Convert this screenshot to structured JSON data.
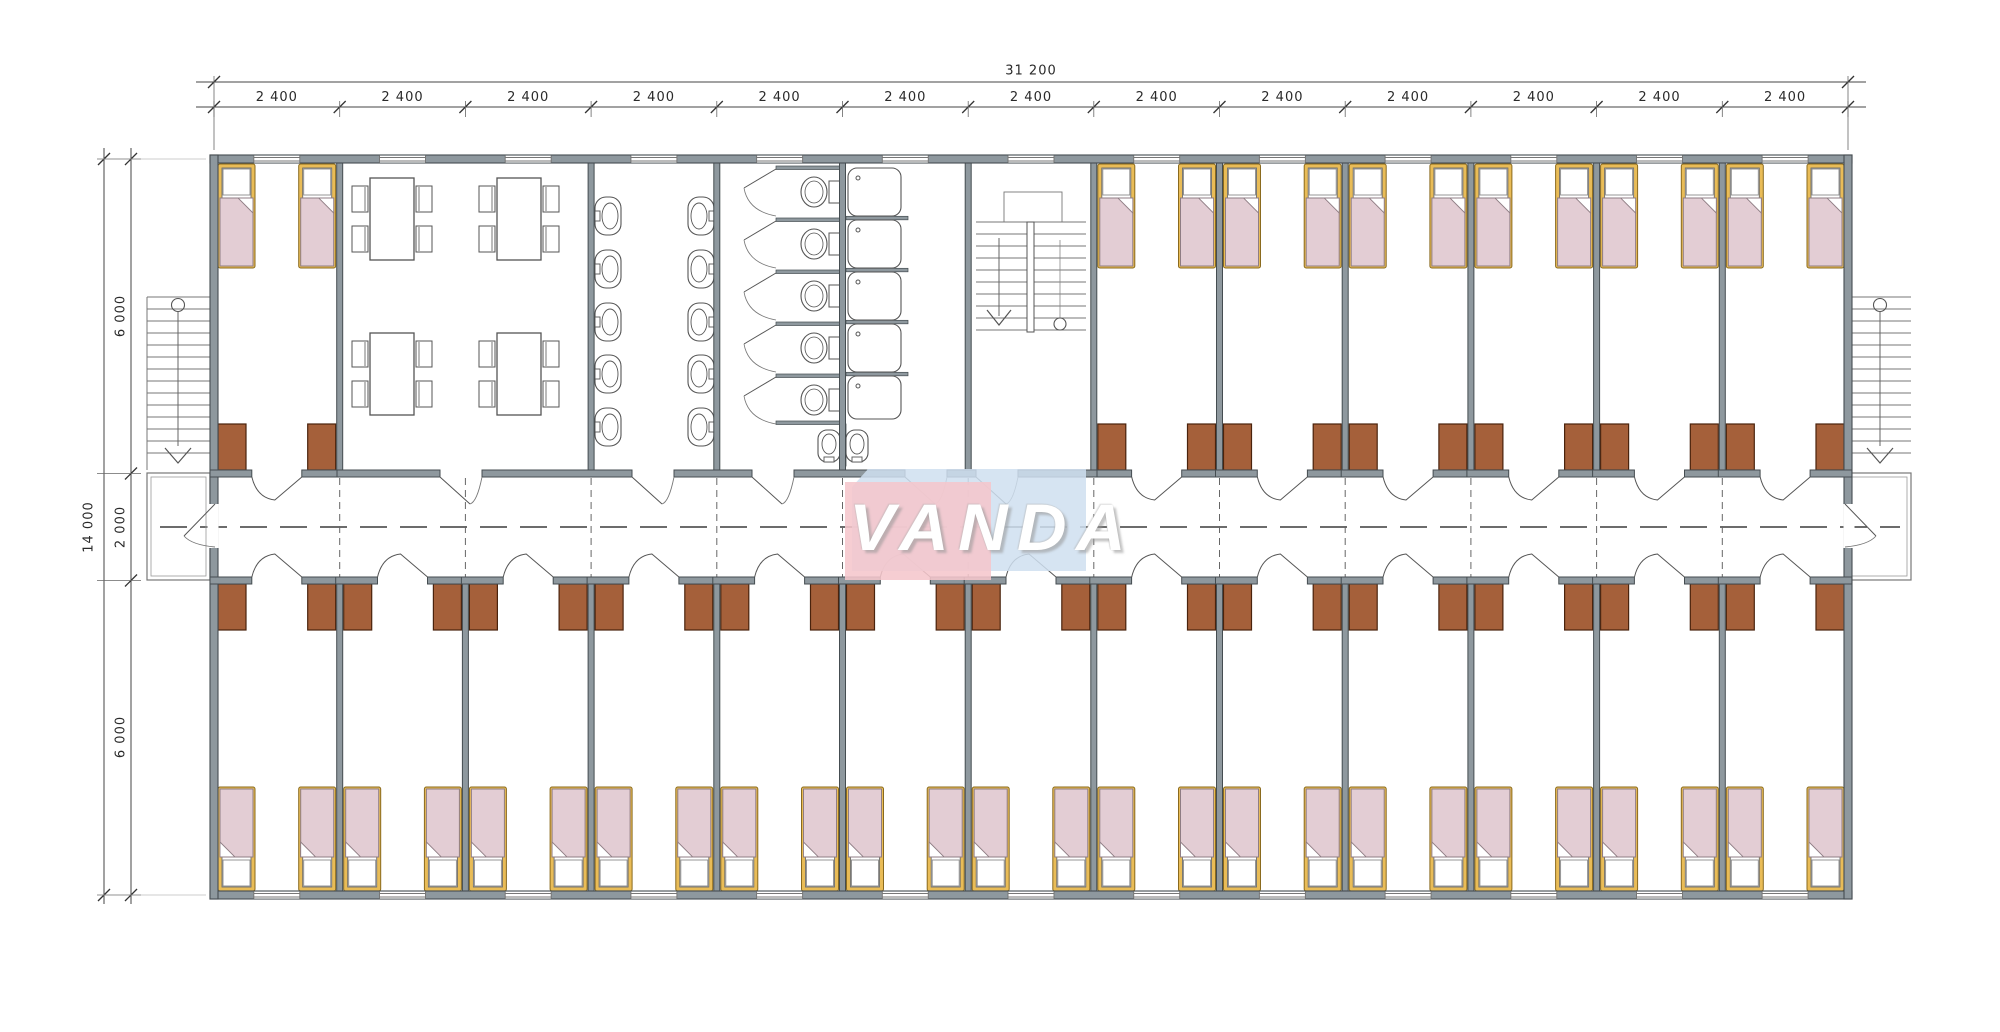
{
  "watermark": {
    "text": "VANDA",
    "pink": "#f5c6cc",
    "blue": "#cfdff0"
  },
  "dimensions": {
    "total_width_label": "31 200",
    "bay_labels": [
      "2 400",
      "2 400",
      "2 400",
      "2 400",
      "2 400",
      "2 400",
      "2 400",
      "2 400",
      "2 400",
      "2 400",
      "2 400",
      "2 400",
      "2 400"
    ],
    "total_height_label": "14 000",
    "height_segment_labels": [
      "6 000",
      "2 000",
      "6 000"
    ]
  },
  "plan": {
    "upper_rooms": [
      "dormitory-room",
      "dining-room",
      "washroom",
      "toilet-room",
      "shower-room",
      "stairwell",
      "dormitory-room",
      "dormitory-room",
      "dormitory-room",
      "dormitory-room",
      "dormitory-room",
      "dormitory-room"
    ],
    "lower_rooms": [
      "dormitory-room",
      "dormitory-room",
      "dormitory-room",
      "dormitory-room",
      "dormitory-room",
      "dormitory-room",
      "dormitory-room",
      "dormitory-room",
      "dormitory-room",
      "dormitory-room",
      "dormitory-room",
      "dormitory-room",
      "dormitory-room"
    ]
  },
  "colors": {
    "wall": "#8e989e",
    "wallEdge": "#454d51",
    "thin": "#5a5a5a",
    "dim": "#2a2a2a",
    "bedFrame": "#e9bc57",
    "bedFrameEdge": "#8a6a1e",
    "blanket": "#e3cdd4",
    "blanketEdge": "#8f7d84",
    "pillow": "#ffffff",
    "desk": "#a5603a",
    "deskEdge": "#4a230d"
  }
}
